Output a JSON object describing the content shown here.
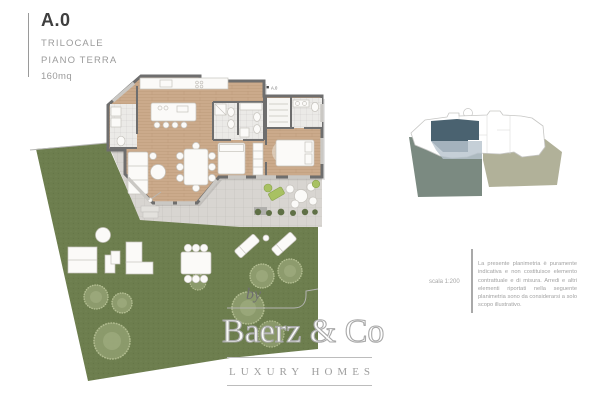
{
  "header": {
    "unit_code": "A.0",
    "typology": "TRILOCALE",
    "floor": "PIANO TERRA",
    "area": "160mq"
  },
  "floor_plan": {
    "unit_label": "A.0"
  },
  "annotations": {
    "scale_note": "scala 1:200",
    "disclaimer": "La presente planimetria è puramente indicativa e non costituisce elemento contrattuale e di misura. Arredi e altri elementi riportati nella seguente planimetria sono da considerarsi a solo scopo illustrativo."
  },
  "logo": {
    "prefix": "by",
    "brand": "Baerz & Co",
    "tagline": "LUXURY HOMES"
  },
  "colors": {
    "grass": "#6d7e4e",
    "terrace": "#d8d5d1",
    "walls": "#6e6e6e",
    "wood": "#cbaa8b",
    "unit_highlight": "#4a6270",
    "unit_overlay": "#b8c5ce",
    "inset_garden_left": "#7b8a81",
    "inset_garden_right": "#b1b199"
  }
}
